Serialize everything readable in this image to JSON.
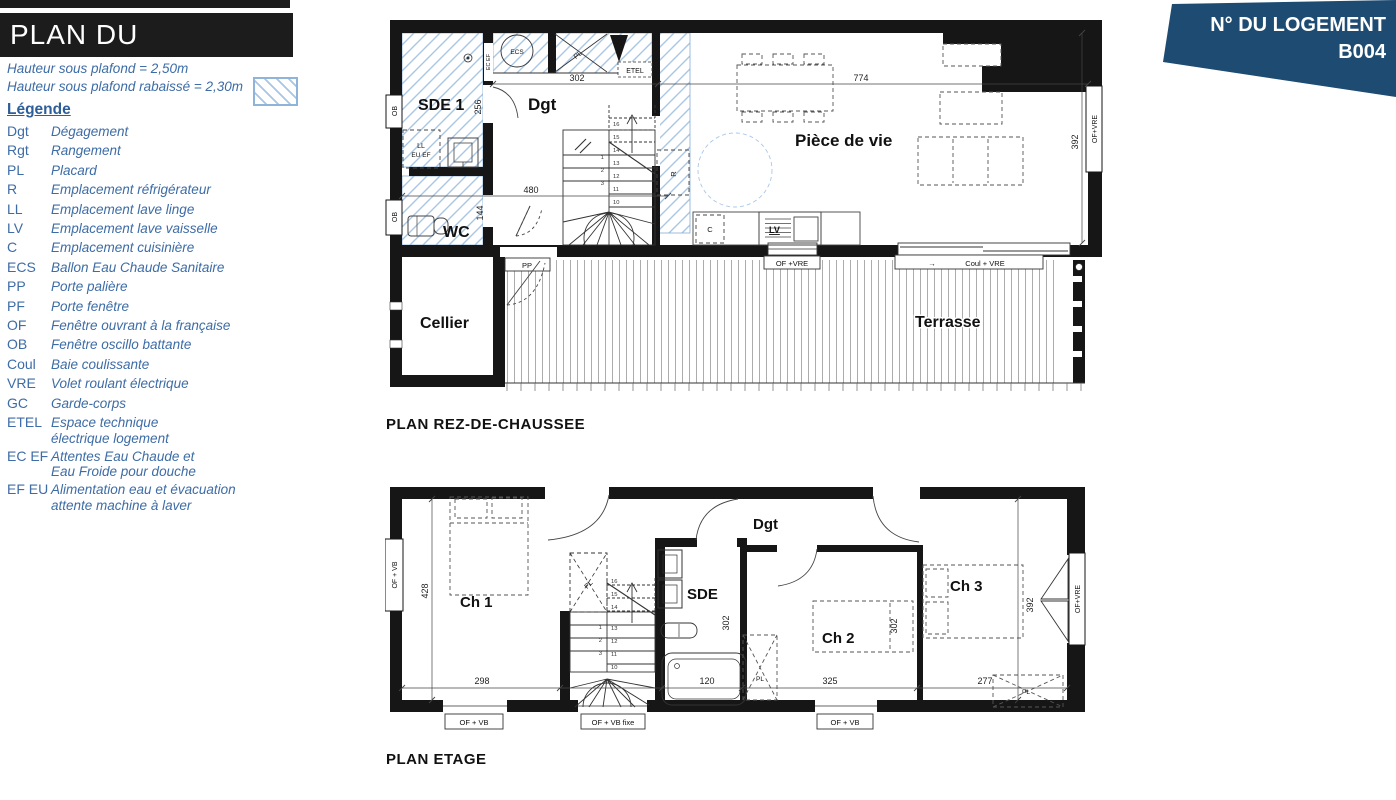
{
  "page": {
    "title_bar": "PLAN DU LOGEMENT"
  },
  "badge": {
    "title": "N° DU LOGEMENT",
    "number": "B004"
  },
  "notes": {
    "line1": "Hauteur sous plafond = 2,50m",
    "line2": "Hauteur sous plafond rabaissé = 2,30m"
  },
  "legend": {
    "heading": "Légende",
    "items": [
      {
        "abbr": "Dgt",
        "desc": "Dégagement"
      },
      {
        "abbr": "Rgt",
        "desc": "Rangement"
      },
      {
        "abbr": "PL",
        "desc": "Placard"
      },
      {
        "abbr": "R",
        "desc": "Emplacement réfrigérateur"
      },
      {
        "abbr": "LL",
        "desc": "Emplacement lave linge"
      },
      {
        "abbr": "LV",
        "desc": "Emplacement lave vaisselle"
      },
      {
        "abbr": "C",
        "desc": "Emplacement cuisinière"
      },
      {
        "abbr": "ECS",
        "desc": "Ballon Eau Chaude Sanitaire"
      },
      {
        "abbr": "PP",
        "desc": "Porte palière"
      },
      {
        "abbr": "PF",
        "desc": "Porte fenêtre"
      },
      {
        "abbr": "OF",
        "desc": "Fenêtre ouvrant à la française"
      },
      {
        "abbr": "OB",
        "desc": "Fenêtre oscillo battante"
      },
      {
        "abbr": "Coul",
        "desc": "Baie coulissante"
      },
      {
        "abbr": "VRE",
        "desc": "Volet roulant électrique"
      },
      {
        "abbr": "GC",
        "desc": "Garde-corps"
      },
      {
        "abbr": "ETEL",
        "desc": "Espace technique\nélectrique logement"
      },
      {
        "abbr": "EC EF",
        "desc": "Attentes Eau Chaude et\nEau Froide pour douche"
      },
      {
        "abbr": "EF EU",
        "desc": "Alimentation eau et évacuation\nattente machine à laver"
      }
    ]
  },
  "ground_floor": {
    "title": "PLAN REZ-DE-CHAUSSEE",
    "rooms": {
      "sde1": "SDE 1",
      "dgt": "Dgt",
      "wc": "WC",
      "cellier": "Cellier",
      "piece_de_vie": "Pièce de vie",
      "terrasse": "Terrasse"
    },
    "features": {
      "ecs": "ECS",
      "pl": "PL",
      "etel": "ETEL",
      "ec_ef": "EC EF",
      "ll": "LL",
      "eu_ef": "EU EF",
      "r": "R",
      "c": "C",
      "lv": "LV"
    },
    "openings": {
      "pp": "PP",
      "ob1": "OB",
      "ob2": "OB",
      "of_vre_right": "OF+VRE",
      "of_vre_bottom": "OF +VRE",
      "coul_vre": "Coul + VRE",
      "coul_arrow": "→"
    },
    "dims": {
      "d302": "302",
      "d774": "774",
      "d256": "256",
      "d480": "480",
      "d144": "144",
      "d392": "392"
    },
    "stairs": {
      "lower": [
        "1",
        "2",
        "3"
      ],
      "upper": [
        "10",
        "11",
        "12",
        "13",
        "14",
        "15",
        "16"
      ]
    }
  },
  "upper_floor": {
    "title": "PLAN ETAGE",
    "rooms": {
      "ch1": "Ch 1",
      "ch2": "Ch 2",
      "ch3": "Ch 3",
      "sde": "SDE",
      "dgt": "Dgt"
    },
    "features": {
      "pl1": "PL",
      "pl2": "PL",
      "pl3": "PL"
    },
    "openings": {
      "of_vb_left": "OF + VB",
      "of_vb_1": "OF + VB",
      "of_vb_fixe": "OF + VB fixe",
      "of_vb_2": "OF + VB",
      "of_vre_right": "OF+VRE"
    },
    "dims": {
      "d428": "428",
      "d298": "298",
      "d302_sde": "302",
      "d302_ch2": "302",
      "d120": "120",
      "d325": "325",
      "d277": "277",
      "d392": "392"
    },
    "stairs": {
      "lower": [
        "1",
        "2",
        "3"
      ],
      "upper": [
        "10",
        "11",
        "12",
        "13",
        "14",
        "15",
        "16"
      ]
    }
  },
  "colors": {
    "badge_bg": "#1d4b72",
    "legend_text": "#3d6ca6",
    "hatch_line": "#a9c6e5",
    "wall": "#161616"
  }
}
